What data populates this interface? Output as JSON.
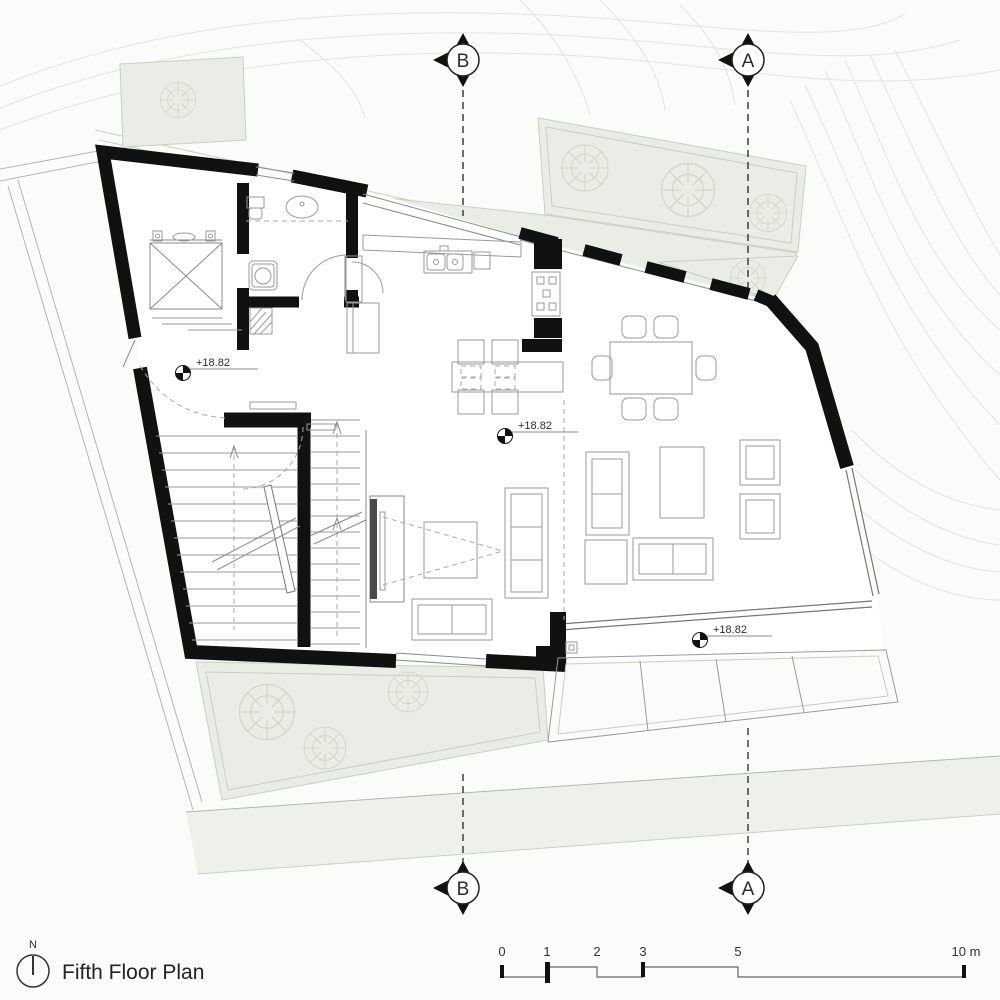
{
  "drawing_title": {
    "title": "Fifth Floor Plan",
    "north_label": "N"
  },
  "section_markers": {
    "top_b": "B",
    "top_a": "A",
    "bottom_b": "B",
    "bottom_a": "A"
  },
  "level_markers": [
    {
      "value": "+18.82"
    },
    {
      "value": "+18.82"
    },
    {
      "value": "+18.82"
    }
  ],
  "scale_bar": {
    "labels": [
      "0",
      "1",
      "2",
      "3",
      "5",
      "10 m"
    ]
  },
  "colors": {
    "background": "#fbfbf9",
    "wall": "#111111",
    "terrace_green": "#e9ede5",
    "slope_band": "#eef0ea",
    "contour": "#e3e3df",
    "furniture": "#9a9a97",
    "tv_dark": "#4a4a4a"
  },
  "icons": {
    "north": "north-arrow-icon (circle + needle)",
    "section": "section-marker-icon (circle + letter + triangles)",
    "level": "level-datum-icon (quartered circle)",
    "tree": "tree-icon (radial sketch)"
  }
}
